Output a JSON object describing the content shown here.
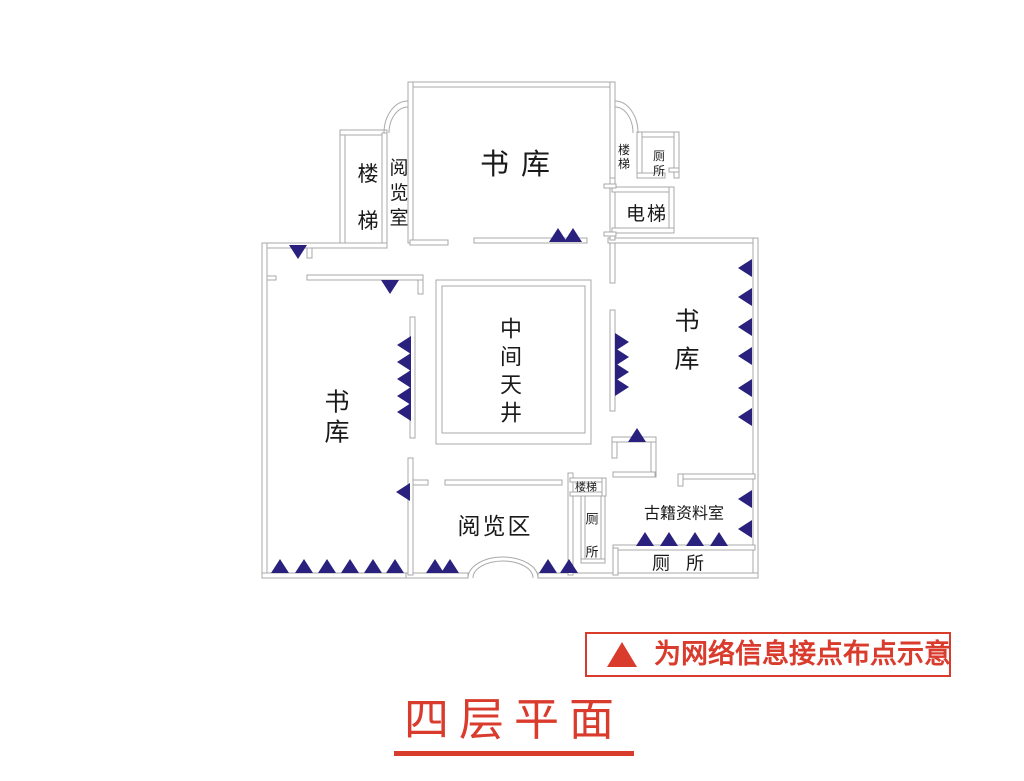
{
  "title": {
    "text": "四层平面"
  },
  "legend": {
    "symbol": "network-point-triangle",
    "text": "为网络信息接点布点示意"
  },
  "colors": {
    "wall_line": "#a9a9a9",
    "network_point": "#29217d",
    "accent_red": "#d93b2d",
    "label_text": "#1a1a1a"
  },
  "floorplan": {
    "rooms": [
      {
        "name": "book-stack-top",
        "text": "书库",
        "x": 521,
        "y": 164,
        "size": 29,
        "dir": "h",
        "ls": 12
      },
      {
        "name": "stairs-top-left",
        "text": "楼梯",
        "x": 368,
        "y": 174,
        "size": 21,
        "dir": "v",
        "gap": 47
      },
      {
        "name": "reading-room-top",
        "text": "阅览室",
        "x": 399,
        "y": 168,
        "size": 19,
        "dir": "v",
        "gap": 25
      },
      {
        "name": "stairs-top-right",
        "text": "楼梯",
        "x": 624,
        "y": 150,
        "size": 12,
        "dir": "v",
        "gap": 14
      },
      {
        "name": "toilet-top-right",
        "text": "厕所",
        "x": 659,
        "y": 156,
        "size": 12,
        "dir": "v",
        "gap": 15
      },
      {
        "name": "elevator",
        "text": "电梯",
        "x": 647,
        "y": 214,
        "size": 19,
        "dir": "h",
        "ls": 2
      },
      {
        "name": "central-courtyard",
        "text": "中间天井",
        "x": 511,
        "y": 330,
        "size": 22,
        "dir": "v",
        "gap": 28
      },
      {
        "name": "book-stack-right",
        "text": "书库",
        "x": 687,
        "y": 321,
        "size": 25,
        "dir": "v",
        "gap": 38
      },
      {
        "name": "book-stack-left",
        "text": "书库",
        "x": 337,
        "y": 402,
        "size": 25,
        "dir": "v",
        "gap": 30
      },
      {
        "name": "reading-area",
        "text": "阅览区",
        "x": 495,
        "y": 527,
        "size": 23,
        "dir": "h",
        "ls": 2
      },
      {
        "name": "stairs-bottom",
        "text": "楼梯",
        "x": 586,
        "y": 487,
        "size": 11,
        "dir": "h",
        "ls": 0
      },
      {
        "name": "toilet-bottom-middle",
        "text": "厕所",
        "x": 592,
        "y": 520,
        "size": 13,
        "dir": "v",
        "gap": 33
      },
      {
        "name": "archives-room",
        "text": "古籍资料室",
        "x": 684,
        "y": 513,
        "size": 16,
        "dir": "h",
        "ls": 0
      },
      {
        "name": "toilet-bottom-right",
        "text": "厕所",
        "x": 686,
        "y": 564,
        "size": 18,
        "dir": "h",
        "ls": 16
      }
    ],
    "walls": [
      [
        408,
        82,
        207,
        5
      ],
      [
        408,
        82,
        5,
        161
      ],
      [
        610,
        82,
        5,
        161
      ],
      [
        340,
        130,
        5,
        115
      ],
      [
        340,
        130,
        47,
        5
      ],
      [
        382,
        133,
        5,
        112
      ],
      [
        262,
        243,
        125,
        5
      ],
      [
        410,
        240,
        38,
        5
      ],
      [
        474,
        238,
        113,
        5
      ],
      [
        608,
        238,
        150,
        5
      ],
      [
        262,
        243,
        5,
        335
      ],
      [
        753,
        238,
        5,
        340
      ],
      [
        262,
        573,
        150,
        5
      ],
      [
        406,
        573,
        62,
        5
      ],
      [
        538,
        573,
        220,
        5
      ],
      [
        637,
        132,
        42,
        5
      ],
      [
        674,
        132,
        5,
        46
      ],
      [
        637,
        132,
        5,
        46
      ],
      [
        637,
        173,
        28,
        5
      ],
      [
        669,
        168,
        10,
        4
      ],
      [
        610,
        178,
        5,
        62
      ],
      [
        612,
        187,
        62,
        5
      ],
      [
        669,
        187,
        5,
        46
      ],
      [
        612,
        228,
        62,
        5
      ],
      [
        604,
        184,
        12,
        4
      ],
      [
        604,
        232,
        12,
        4
      ],
      [
        307,
        248,
        5,
        10
      ],
      [
        307,
        275,
        116,
        5
      ],
      [
        418,
        280,
        5,
        14
      ],
      [
        267,
        276,
        9,
        4
      ],
      [
        410,
        317,
        5,
        121
      ],
      [
        610,
        243,
        5,
        40
      ],
      [
        610,
        310,
        5,
        101
      ],
      [
        612,
        437,
        44,
        5
      ],
      [
        612,
        442,
        5,
        16
      ],
      [
        651,
        442,
        5,
        35
      ],
      [
        613,
        472,
        42,
        5
      ],
      [
        678,
        474,
        77,
        5
      ],
      [
        678,
        474,
        5,
        12
      ],
      [
        613,
        545,
        142,
        5
      ],
      [
        613,
        548,
        5,
        27
      ],
      [
        568,
        473,
        5,
        102
      ],
      [
        570,
        478,
        36,
        4
      ],
      [
        570,
        492,
        36,
        4
      ],
      [
        602,
        478,
        4,
        18
      ],
      [
        581,
        496,
        4,
        66
      ],
      [
        601,
        496,
        4,
        66
      ],
      [
        581,
        559,
        24,
        4
      ],
      [
        408,
        458,
        5,
        117
      ],
      [
        413,
        480,
        15,
        5
      ],
      [
        445,
        480,
        117,
        5
      ]
    ],
    "wall_outlines": [
      [
        436,
        280,
        155,
        164
      ],
      [
        442,
        286,
        143,
        147
      ]
    ],
    "arches": [
      "M408,101 A24,32 0 0 0 384,133",
      "M408,107 A19,26 0 0 0 389,133",
      "M615,101 A23,32 0 0 1 638,133",
      "M615,107 A18,26 0 0 1 633,133",
      "M468,578 A35,21 0 0 1 538,578",
      "M473,578 A30,17 0 0 1 533,578"
    ],
    "network_points": [
      {
        "x": 558,
        "y": 228,
        "d": "up"
      },
      {
        "x": 573,
        "y": 228,
        "d": "up"
      },
      {
        "x": 298,
        "y": 259,
        "d": "down"
      },
      {
        "x": 390,
        "y": 294,
        "d": "down"
      },
      {
        "x": 397,
        "y": 345,
        "d": "left"
      },
      {
        "x": 397,
        "y": 362,
        "d": "left"
      },
      {
        "x": 397,
        "y": 379,
        "d": "left"
      },
      {
        "x": 397,
        "y": 396,
        "d": "left"
      },
      {
        "x": 397,
        "y": 412,
        "d": "left"
      },
      {
        "x": 629,
        "y": 342,
        "d": "right"
      },
      {
        "x": 629,
        "y": 357,
        "d": "right"
      },
      {
        "x": 629,
        "y": 372,
        "d": "right"
      },
      {
        "x": 629,
        "y": 387,
        "d": "right"
      },
      {
        "x": 738,
        "y": 268,
        "d": "left"
      },
      {
        "x": 738,
        "y": 297,
        "d": "left"
      },
      {
        "x": 738,
        "y": 327,
        "d": "left"
      },
      {
        "x": 738,
        "y": 356,
        "d": "left"
      },
      {
        "x": 738,
        "y": 388,
        "d": "left"
      },
      {
        "x": 738,
        "y": 417,
        "d": "left"
      },
      {
        "x": 637,
        "y": 428,
        "d": "up"
      },
      {
        "x": 738,
        "y": 499,
        "d": "left"
      },
      {
        "x": 738,
        "y": 529,
        "d": "left"
      },
      {
        "x": 396,
        "y": 492,
        "d": "left"
      },
      {
        "x": 645,
        "y": 532,
        "d": "up"
      },
      {
        "x": 669,
        "y": 532,
        "d": "up"
      },
      {
        "x": 695,
        "y": 532,
        "d": "up"
      },
      {
        "x": 719,
        "y": 532,
        "d": "up"
      },
      {
        "x": 280,
        "y": 559,
        "d": "up"
      },
      {
        "x": 304,
        "y": 559,
        "d": "up"
      },
      {
        "x": 327,
        "y": 559,
        "d": "up"
      },
      {
        "x": 350,
        "y": 559,
        "d": "up"
      },
      {
        "x": 373,
        "y": 559,
        "d": "up"
      },
      {
        "x": 395,
        "y": 559,
        "d": "up"
      },
      {
        "x": 435,
        "y": 559,
        "d": "up"
      },
      {
        "x": 450,
        "y": 559,
        "d": "up"
      },
      {
        "x": 548,
        "y": 559,
        "d": "up"
      },
      {
        "x": 569,
        "y": 559,
        "d": "up"
      }
    ]
  }
}
